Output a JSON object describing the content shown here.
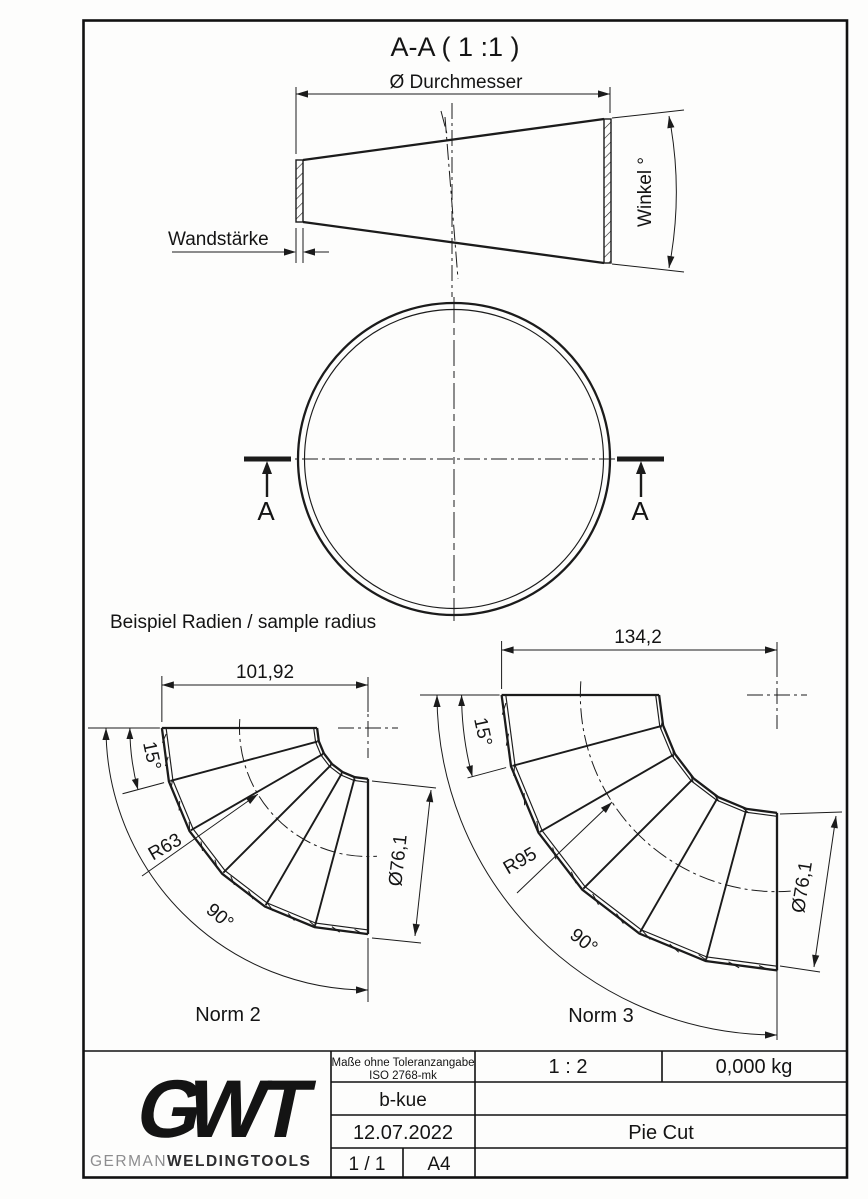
{
  "colors": {
    "line": "#1b1b1b",
    "logo_dark": "#39393b",
    "logo_mid": "#5a5a5c",
    "logo_t": "#4b4b4d",
    "brand_light": "#8d8d8f",
    "brand_dark": "#2e2e30"
  },
  "drawing": {
    "section_title": "A-A ( 1 :1 )",
    "section_marker": "A",
    "cone": {
      "diameter_label": "Ø Durchmesser",
      "wall_label": "Wandstärke",
      "angle_label": "Winkel °"
    },
    "sample_heading": "Beispiel Radien / sample radius",
    "elbows": [
      {
        "name": "Norm 2",
        "width_dim": "101,92",
        "segment_angle_label": "15°",
        "radius_label": "R63",
        "bend_angle_label": "90°",
        "diameter_label": "Ø76,1",
        "geometry": {
          "radius_mm": 63,
          "pipe_od_mm": 76.1,
          "bend_deg": 90,
          "segments": 6
        }
      },
      {
        "name": "Norm 3",
        "width_dim": "134,2",
        "segment_angle_label": "15°",
        "radius_label": "R95",
        "bend_angle_label": "90°",
        "diameter_label": "Ø76,1",
        "geometry": {
          "radius_mm": 95,
          "pipe_od_mm": 76.1,
          "bend_deg": 90,
          "segments": 6
        }
      }
    ]
  },
  "title_block": {
    "tolerance_line1": "Maße ohne Toleranzangabe",
    "tolerance_line2": "ISO 2768-mk",
    "scale": "1 : 2",
    "weight": "0,000 kg",
    "author": "b-kue",
    "date": "12.07.2022",
    "part_title": "Pie Cut",
    "sheet": "1 / 1",
    "format": "A4",
    "logo": {
      "letter_g": "G",
      "letter_w": "W",
      "letter_t": "T",
      "brand_light": "GERMAN",
      "brand_bold": "WELDINGTOOLS"
    }
  }
}
